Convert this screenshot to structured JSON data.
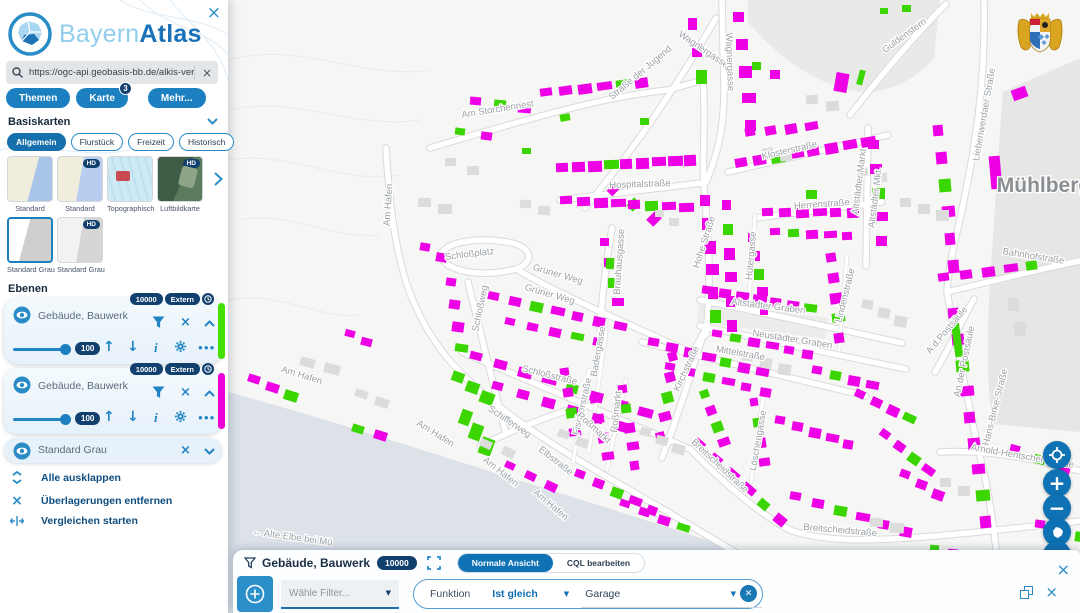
{
  "brand": {
    "part1": "Bayern",
    "part2": "Atlas"
  },
  "search": {
    "value": "https://ogc-api.geobasis-bb.de/alkis-verein"
  },
  "nav": {
    "themen": "Themen",
    "karte": "Karte",
    "karte_badge": "3",
    "mehr": "Mehr..."
  },
  "basiskarten": {
    "title": "Basiskarten",
    "tabs": [
      "Allgemein",
      "Flurstück",
      "Freizeit",
      "Historisch"
    ],
    "hd_badge": "HD",
    "thumbs": [
      {
        "label": "Standard",
        "hd": false
      },
      {
        "label": "Standard",
        "hd": true
      },
      {
        "label": "Topographisch",
        "hd": false
      },
      {
        "label": "Luftbildkarte",
        "hd": true
      },
      {
        "label": "Standard Grau",
        "hd": false,
        "selected": true
      },
      {
        "label": "Standard Grau",
        "hd": true
      }
    ]
  },
  "ebenen": {
    "title": "Ebenen",
    "layers": [
      {
        "name": "Gebäude, Bauwerk",
        "badge_count": "10000",
        "badge_type": "Extern",
        "opacity": "100",
        "stripe_color": "#44e000"
      },
      {
        "name": "Gebäude, Bauwerk",
        "badge_count": "10000",
        "badge_type": "Extern",
        "opacity": "100",
        "stripe_color": "#ee00d9"
      }
    ],
    "base_layer": "Standard Grau"
  },
  "actions": {
    "expand_all": "Alle ausklappen",
    "remove_overlays": "Überlagerungen entfernen",
    "start_compare": "Vergleichen starten"
  },
  "controls": {
    "threed": "3D"
  },
  "filter_panel": {
    "title": "Gebäude, Bauwerk",
    "badge": "10000",
    "views": [
      "Normale Ansicht",
      "CQL bearbeiten"
    ],
    "active_view": "Normale Ansicht",
    "filter_placeholder": "Wähle Filter...",
    "function_label": "Funktion",
    "operator": "Ist gleich",
    "value": "Garage"
  },
  "map": {
    "colors": {
      "m": "#ed00e6",
      "g": "#3bd500",
      "x": "#dcdcda"
    },
    "city_label": "Mühlberg",
    "labels": [
      [
        "Am Storchennest",
        498,
        112,
        -9
      ],
      [
        "Wagnergasse",
        702,
        52,
        34
      ],
      [
        "Wagnergasse",
        727,
        62,
        88
      ],
      [
        "Straße der Jugend",
        642,
        75,
        -40
      ],
      [
        "Guldenstern",
        906,
        38,
        -36
      ],
      [
        "Liebenwerdaer Straße",
        987,
        115,
        -80
      ],
      [
        "Klosterstraße",
        790,
        153,
        -13
      ],
      [
        "Hospitalstraße",
        640,
        187,
        -2
      ],
      [
        "Herrenstraße",
        822,
        207,
        -4
      ],
      [
        "Altstädter Markt",
        862,
        182,
        -83
      ],
      [
        "Altstädter Mkt.",
        878,
        198,
        -83
      ],
      [
        "Hohe Straße",
        707,
        243,
        -72
      ],
      [
        "Hütergasse",
        754,
        256,
        -85
      ],
      [
        "Schloßplatz",
        470,
        257,
        -7
      ],
      [
        "Grüner Weg",
        557,
        277,
        16
      ],
      [
        "Grüner Weg",
        549,
        297,
        16
      ],
      [
        "Schloßweg",
        483,
        309,
        -78
      ],
      [
        "Brauhausgasse",
        622,
        262,
        -86
      ],
      [
        "Altstädter Graben",
        768,
        309,
        7
      ],
      [
        "Neustädter Graben",
        792,
        342,
        9
      ],
      [
        "Mittelstraße",
        740,
        356,
        10
      ],
      [
        "Kirchstraße",
        689,
        370,
        -65
      ],
      [
        "Badergasse",
        601,
        352,
        -80
      ],
      [
        "Fischerstraße",
        585,
        407,
        -77
      ],
      [
        "Roßmarkt",
        619,
        412,
        -84
      ],
      [
        "Roßmarkt",
        592,
        430,
        42
      ],
      [
        "Schloßstraße",
        549,
        378,
        14
      ],
      [
        "Elbstraße",
        554,
        463,
        38
      ],
      [
        "Breitscheidstraße",
        718,
        468,
        43
      ],
      [
        "Breitscheidstraße",
        840,
        533,
        5
      ],
      [
        "Löschengasse",
        761,
        441,
        -80
      ],
      [
        "Lindenstraße",
        848,
        296,
        -76
      ],
      [
        "Am Hafen",
        391,
        205,
        -86
      ],
      [
        "Am Hafen",
        301,
        378,
        17
      ],
      [
        "Am Hafen",
        434,
        436,
        32
      ],
      [
        "Am Hafen",
        499,
        474,
        38
      ],
      [
        "Am Hafen",
        549,
        507,
        40
      ],
      [
        "Schifferweg",
        508,
        424,
        34
      ],
      [
        "← Alte Elbe bei Mü",
        292,
        540,
        8
      ],
      [
        "Mühlberg",
        1044,
        192,
        0,
        21,
        "#8a8e92",
        700
      ],
      [
        "Bahnhofstraße",
        1033,
        259,
        9
      ],
      [
        "An der Postsäule",
        967,
        362,
        -78
      ],
      [
        "A.d.Postsäule",
        949,
        332,
        -50
      ],
      [
        "Hans-Birke-Straße",
        998,
        408,
        -76
      ],
      [
        "Arnold-Hentschel-Straße",
        1022,
        459,
        10
      ]
    ],
    "buildings": [
      [
        470,
        97,
        3,
        24,
        3,
        12,
        9,
        5,
        "mgm"
      ],
      [
        540,
        88,
        6,
        19,
        -2,
        13,
        9,
        -8,
        "mmmmgm"
      ],
      [
        455,
        128,
        2,
        26,
        4,
        11,
        8,
        8,
        "gm"
      ],
      [
        608,
        186,
        3,
        20,
        14,
        11,
        9,
        -45,
        "mgm"
      ],
      [
        688,
        18,
        3,
        4,
        26,
        10,
        13,
        0,
        "mmg"
      ],
      [
        733,
        12,
        5,
        3,
        27,
        12,
        11,
        0,
        "mmmmm"
      ],
      [
        752,
        62,
        2,
        18,
        8,
        10,
        9,
        0,
        "gm"
      ],
      [
        835,
        73,
        1,
        0,
        0,
        14,
        20,
        10,
        "m"
      ],
      [
        858,
        70,
        1,
        0,
        0,
        7,
        16,
        15,
        "g"
      ],
      [
        1012,
        88,
        1,
        0,
        0,
        16,
        12,
        -20,
        "m"
      ],
      [
        880,
        8,
        2,
        22,
        -3,
        9,
        7,
        0,
        "gg"
      ],
      [
        556,
        163,
        9,
        16,
        -1,
        13,
        10,
        -2,
        "mmmgmmmmm"
      ],
      [
        560,
        196,
        8,
        17,
        1,
        13,
        9,
        -2,
        "mmmmmgmm"
      ],
      [
        735,
        158,
        8,
        18,
        -3,
        13,
        10,
        -10,
        "mmgmmmmm"
      ],
      [
        745,
        128,
        4,
        20,
        -2,
        11,
        9,
        -10,
        "mmmm"
      ],
      [
        762,
        208,
        6,
        17,
        0,
        12,
        9,
        -3,
        "mmmmmm"
      ],
      [
        770,
        228,
        5,
        18,
        1,
        11,
        8,
        -3,
        "mgmmm"
      ],
      [
        868,
        140,
        5,
        2,
        24,
        12,
        10,
        0,
        "mmgmm"
      ],
      [
        700,
        195,
        6,
        2,
        23,
        11,
        12,
        0,
        "mmmmmg"
      ],
      [
        722,
        200,
        6,
        1,
        24,
        10,
        11,
        0,
        "mgmmmm"
      ],
      [
        748,
        233,
        5,
        3,
        18,
        9,
        10,
        0,
        "mmgmm"
      ],
      [
        488,
        292,
        7,
        21,
        5,
        12,
        9,
        12,
        "mmgmmmm"
      ],
      [
        505,
        318,
        5,
        22,
        5,
        11,
        8,
        12,
        "mmmgm"
      ],
      [
        600,
        238,
        4,
        4,
        20,
        10,
        9,
        0,
        "mmgm"
      ],
      [
        446,
        278,
        4,
        3,
        22,
        11,
        9,
        8,
        "mmmg"
      ],
      [
        452,
        372,
        3,
        14,
        10,
        13,
        11,
        20,
        "ggg"
      ],
      [
        470,
        352,
        8,
        24,
        8,
        13,
        9,
        15,
        "mmmmgmmm"
      ],
      [
        492,
        382,
        6,
        25,
        8,
        12,
        9,
        15,
        "mmmmmm"
      ],
      [
        560,
        368,
        4,
        3,
        20,
        10,
        9,
        -8,
        "mmgm"
      ],
      [
        590,
        395,
        4,
        4,
        19,
        10,
        9,
        -8,
        "mmmm"
      ],
      [
        618,
        385,
        5,
        3,
        19,
        10,
        9,
        -8,
        "mgmmm"
      ],
      [
        648,
        338,
        7,
        18,
        5,
        12,
        9,
        10,
        "mmmmgmm"
      ],
      [
        665,
        363,
        6,
        19,
        5,
        11,
        8,
        10,
        "mmgmmm"
      ],
      [
        702,
        286,
        7,
        17,
        3,
        12,
        9,
        7,
        "mmmmmmg"
      ],
      [
        712,
        330,
        6,
        18,
        4,
        11,
        8,
        9,
        "mgmmmm"
      ],
      [
        668,
        352,
        5,
        -3,
        20,
        10,
        10,
        -15,
        "mmgmm"
      ],
      [
        826,
        253,
        5,
        2,
        20,
        11,
        10,
        -8,
        "mmmgm"
      ],
      [
        750,
        398,
        4,
        3,
        20,
        9,
        9,
        -8,
        "mgmm"
      ],
      [
        694,
        440,
        6,
        16,
        15,
        12,
        9,
        40,
        "mmmmgm"
      ],
      [
        790,
        492,
        6,
        22,
        7,
        12,
        9,
        10,
        "mmgmmm"
      ],
      [
        938,
        273,
        5,
        22,
        -3,
        12,
        9,
        -8,
        "mmmmg"
      ],
      [
        933,
        125,
        6,
        3,
        27,
        11,
        12,
        -5,
        "mmgmmm"
      ],
      [
        948,
        308,
        9,
        4,
        26,
        12,
        11,
        -5,
        "mmgmmmmgm"
      ],
      [
        953,
        320,
        1,
        0,
        0,
        9,
        38,
        -8,
        "g"
      ],
      [
        990,
        156,
        1,
        0,
        0,
        12,
        34,
        -5,
        "m"
      ],
      [
        1010,
        445,
        3,
        24,
        10,
        11,
        9,
        15,
        "mgm"
      ],
      [
        1035,
        520,
        3,
        20,
        6,
        11,
        9,
        8,
        "mmg"
      ],
      [
        248,
        375,
        3,
        18,
        8,
        13,
        9,
        18,
        "mmg"
      ],
      [
        345,
        330,
        2,
        16,
        8,
        11,
        8,
        15,
        "mm"
      ],
      [
        352,
        425,
        2,
        22,
        6,
        13,
        9,
        18,
        "gm"
      ],
      [
        460,
        410,
        3,
        10,
        14,
        12,
        16,
        20,
        "ggg"
      ],
      [
        505,
        462,
        3,
        20,
        10,
        11,
        8,
        25,
        "mmm"
      ],
      [
        575,
        470,
        5,
        18,
        9,
        11,
        9,
        20,
        "mmgmm"
      ],
      [
        620,
        500,
        4,
        19,
        8,
        11,
        8,
        18,
        "mmmg"
      ],
      [
        700,
        390,
        4,
        6,
        16,
        10,
        9,
        -20,
        "gmgm"
      ],
      [
        775,
        416,
        5,
        17,
        6,
        11,
        9,
        10,
        "mmmmm"
      ],
      [
        812,
        366,
        4,
        18,
        5,
        11,
        9,
        10,
        "mgmm"
      ],
      [
        855,
        390,
        4,
        16,
        8,
        11,
        9,
        25,
        "mmmg"
      ],
      [
        880,
        430,
        4,
        14,
        12,
        11,
        9,
        35,
        "mmgm"
      ],
      [
        900,
        470,
        3,
        16,
        10,
        11,
        9,
        20,
        "mmm"
      ],
      [
        930,
        545,
        2,
        18,
        4,
        10,
        8,
        5,
        "gm"
      ],
      [
        420,
        243,
        2,
        16,
        10,
        11,
        9,
        10,
        "mm"
      ],
      [
        522,
        148,
        1,
        0,
        0,
        10,
        7,
        0,
        "g"
      ],
      [
        560,
        114,
        1,
        0,
        0,
        11,
        8,
        -10,
        "g"
      ],
      [
        640,
        118,
        1,
        0,
        0,
        10,
        8,
        0,
        "g"
      ],
      [
        606,
        258,
        1,
        0,
        0,
        9,
        12,
        5,
        "g"
      ],
      [
        806,
        190,
        1,
        0,
        0,
        12,
        10,
        0,
        "g"
      ],
      [
        418,
        198,
        2,
        20,
        6,
        14,
        10,
        0,
        "xx"
      ],
      [
        445,
        158,
        2,
        22,
        8,
        12,
        9,
        0,
        "xx"
      ],
      [
        300,
        358,
        2,
        24,
        6,
        16,
        10,
        15,
        "xx"
      ],
      [
        355,
        390,
        2,
        20,
        8,
        14,
        9,
        18,
        "xx"
      ],
      [
        480,
        440,
        2,
        22,
        8,
        13,
        9,
        25,
        "xx"
      ],
      [
        742,
        352,
        3,
        18,
        6,
        12,
        10,
        8,
        "xxx"
      ],
      [
        862,
        300,
        3,
        16,
        8,
        12,
        10,
        10,
        "xxx"
      ],
      [
        900,
        198,
        3,
        18,
        6,
        12,
        10,
        0,
        "xxx"
      ],
      [
        940,
        478,
        2,
        18,
        8,
        12,
        10,
        0,
        "xx"
      ],
      [
        1008,
        298,
        2,
        6,
        24,
        12,
        14,
        0,
        "xx"
      ],
      [
        870,
        518,
        2,
        20,
        5,
        14,
        10,
        5,
        "xx"
      ],
      [
        640,
        428,
        3,
        16,
        8,
        12,
        9,
        15,
        "xxx"
      ],
      [
        558,
        430,
        2,
        18,
        8,
        12,
        9,
        20,
        "xx"
      ],
      [
        762,
        148,
        2,
        18,
        4,
        12,
        9,
        -8,
        "xx"
      ],
      [
        806,
        95,
        2,
        20,
        6,
        13,
        10,
        -5,
        "xx"
      ],
      [
        857,
        168,
        2,
        18,
        5,
        12,
        9,
        -5,
        "xx"
      ],
      [
        655,
        210,
        2,
        14,
        8,
        10,
        8,
        0,
        "xx"
      ],
      [
        520,
        200,
        2,
        18,
        6,
        12,
        9,
        5,
        "xx"
      ]
    ]
  }
}
